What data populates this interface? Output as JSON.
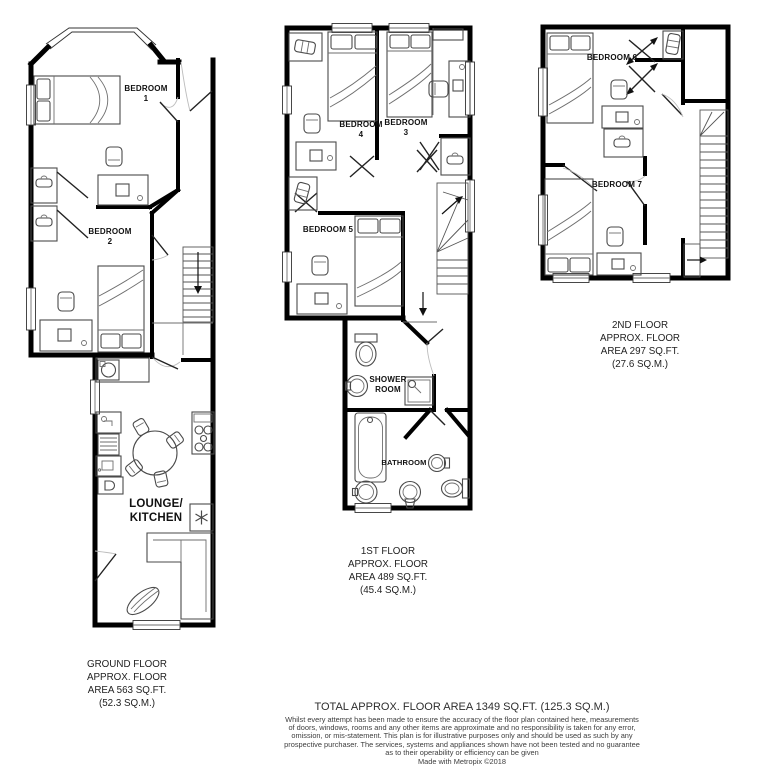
{
  "meta": {
    "background": "#ffffff",
    "wall_color": "#000000",
    "furniture_color": "#4a4a4a"
  },
  "floors": {
    "ground": {
      "rooms": {
        "bedroom1": "BEDROOM\n1",
        "bedroom2": "BEDROOM\n2",
        "lounge_kitchen": "LOUNGE/\nKITCHEN"
      },
      "caption": "GROUND FLOOR\nAPPROX. FLOOR\nAREA 563 SQ.FT.\n(52.3 SQ.M.)"
    },
    "first": {
      "rooms": {
        "bedroom4": "BEDROOM\n4",
        "bedroom3": "BEDROOM\n3",
        "bedroom5": "BEDROOM 5",
        "shower_room": "SHOWER\nROOM",
        "bathroom": "BATHROOM"
      },
      "caption": "1ST FLOOR\nAPPROX. FLOOR\nAREA 489 SQ.FT.\n(45.4 SQ.M.)"
    },
    "second": {
      "rooms": {
        "bedroom6": "BEDROOM 6",
        "bedroom7": "BEDROOM 7"
      },
      "caption": "2ND FLOOR\nAPPROX. FLOOR\nAREA 297 SQ.FT.\n(27.6 SQ.M.)"
    }
  },
  "footer": {
    "total": "TOTAL APPROX. FLOOR AREA 1349 SQ.FT. (125.3 SQ.M.)",
    "disclaimer": "Whilst every attempt has been made to ensure the accuracy of the floor plan contained here, measurements\nof doors, windows, rooms and any other items are approximate and no responsibility is taken for any error,\nomission, or mis-statement. This plan is for illustrative purposes only and should be used as such by any\nprospective purchaser. The services, systems and appliances shown have not been tested and no guarantee\nas to their operability or efficiency can be given",
    "credit": "Made with Metropix ©2018"
  }
}
